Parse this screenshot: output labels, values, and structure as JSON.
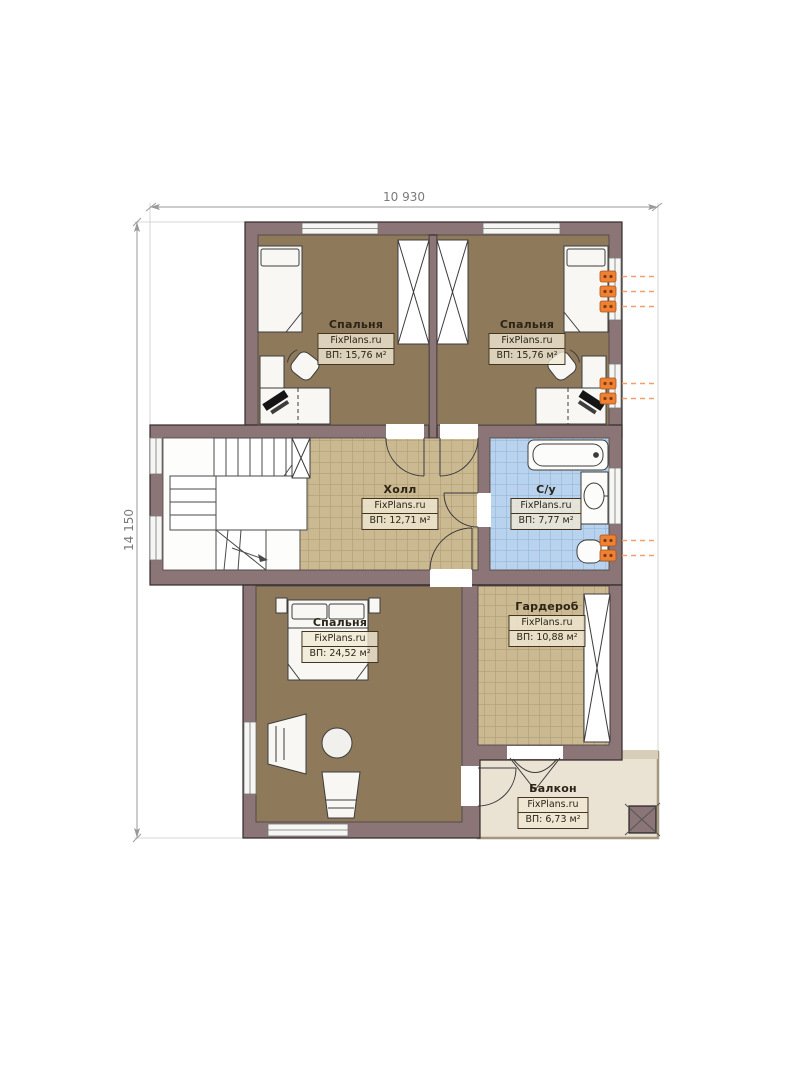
{
  "plan": {
    "dimensions": {
      "width": "10 930",
      "height": "14 150"
    },
    "rooms": [
      {
        "key": "bedroom-top-left",
        "name": "Спальня",
        "site": "FixPlans.ru",
        "area": "ВП: 15,76 м²"
      },
      {
        "key": "bedroom-top-right",
        "name": "Спальня",
        "site": "FixPlans.ru",
        "area": "ВП: 15,76 м²"
      },
      {
        "key": "hall",
        "name": "Холл",
        "site": "FixPlans.ru",
        "area": "ВП: 12,71 м²"
      },
      {
        "key": "bathroom",
        "name": "С/у",
        "site": "FixPlans.ru",
        "area": "ВП: 7,77 м²"
      },
      {
        "key": "bedroom-bottom",
        "name": "Спальня",
        "site": "FixPlans.ru",
        "area": "ВП: 24,52 м²"
      },
      {
        "key": "wardrobe",
        "name": "Гардероб",
        "site": "FixPlans.ru",
        "area": "ВП: 10,88 м²"
      },
      {
        "key": "balcony",
        "name": "Балкон",
        "site": "FixPlans.ru",
        "area": "ВП: 6,73 м²"
      }
    ],
    "colors": {
      "wall": "#8b7576",
      "bedroom_floor": "#8e7a5b",
      "tile_floor": "#cbb992",
      "bathroom_tile": "#b9d3ee",
      "balcony_floor": "#eae2d2",
      "outlet_accent": "#ee8134",
      "dimension_text": "#7a7a7a"
    }
  }
}
